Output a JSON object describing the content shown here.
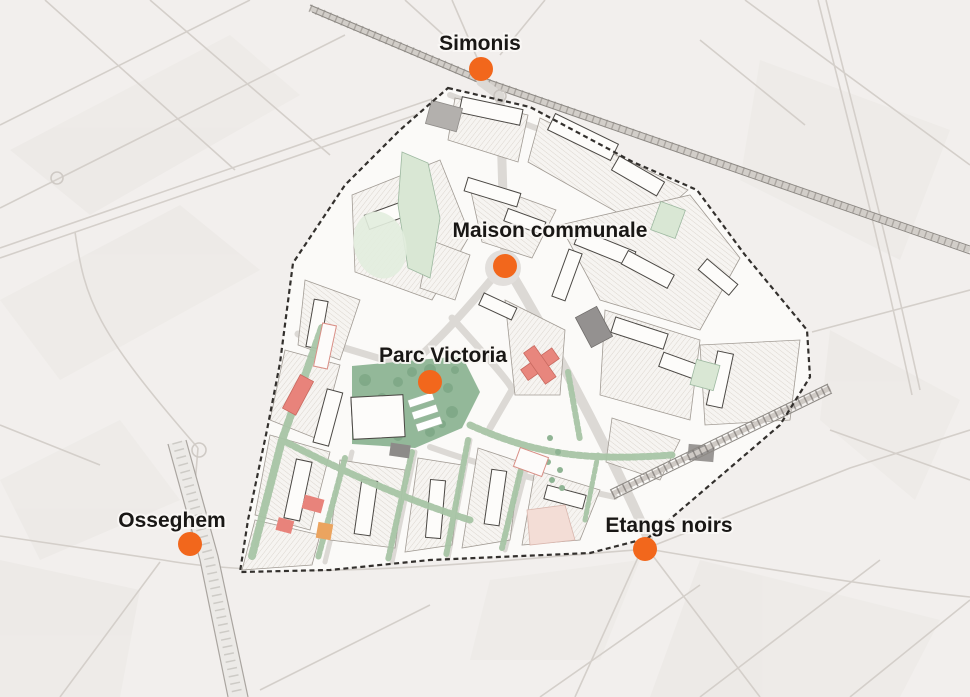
{
  "map": {
    "kind": "urban-masterplan-map",
    "colors": {
      "background": "#f2efed",
      "study_area_fill": "#fbfaf8",
      "boundary": "#33302d",
      "marker_orange": "#f2671c",
      "label_text": "#191715",
      "park_green": "#93b899",
      "corridor_green": "#a8c5a6",
      "pale_green": "#d9e7d4",
      "accent_red": "#e8867d",
      "pale_pink": "#f3ddd6",
      "accent_orange_building": "#eba45f",
      "dark_building_gray": "#949190",
      "road_gray": "#dcd9d5"
    },
    "stations": [
      {
        "id": "simonis",
        "name": "Simonis",
        "dot": {
          "x": 481,
          "y": 69,
          "r": 12
        },
        "label": {
          "x": 480,
          "y": 50,
          "anchor": "middle"
        }
      },
      {
        "id": "maison-communale",
        "name": "Maison communale",
        "dot": {
          "x": 505,
          "y": 266,
          "r": 12
        },
        "label": {
          "x": 550,
          "y": 237,
          "anchor": "middle"
        }
      },
      {
        "id": "parc-victoria",
        "name": "Parc Victoria",
        "dot": {
          "x": 430,
          "y": 382,
          "r": 12
        },
        "label": {
          "x": 443,
          "y": 362,
          "anchor": "middle"
        }
      },
      {
        "id": "osseghem",
        "name": "Osseghem",
        "dot": {
          "x": 190,
          "y": 544,
          "r": 12
        },
        "label": {
          "x": 172,
          "y": 527,
          "anchor": "middle"
        }
      },
      {
        "id": "etangs-noirs",
        "name": "Etangs noirs",
        "dot": {
          "x": 645,
          "y": 549,
          "r": 12
        },
        "label": {
          "x": 669,
          "y": 532,
          "anchor": "middle"
        }
      }
    ]
  }
}
